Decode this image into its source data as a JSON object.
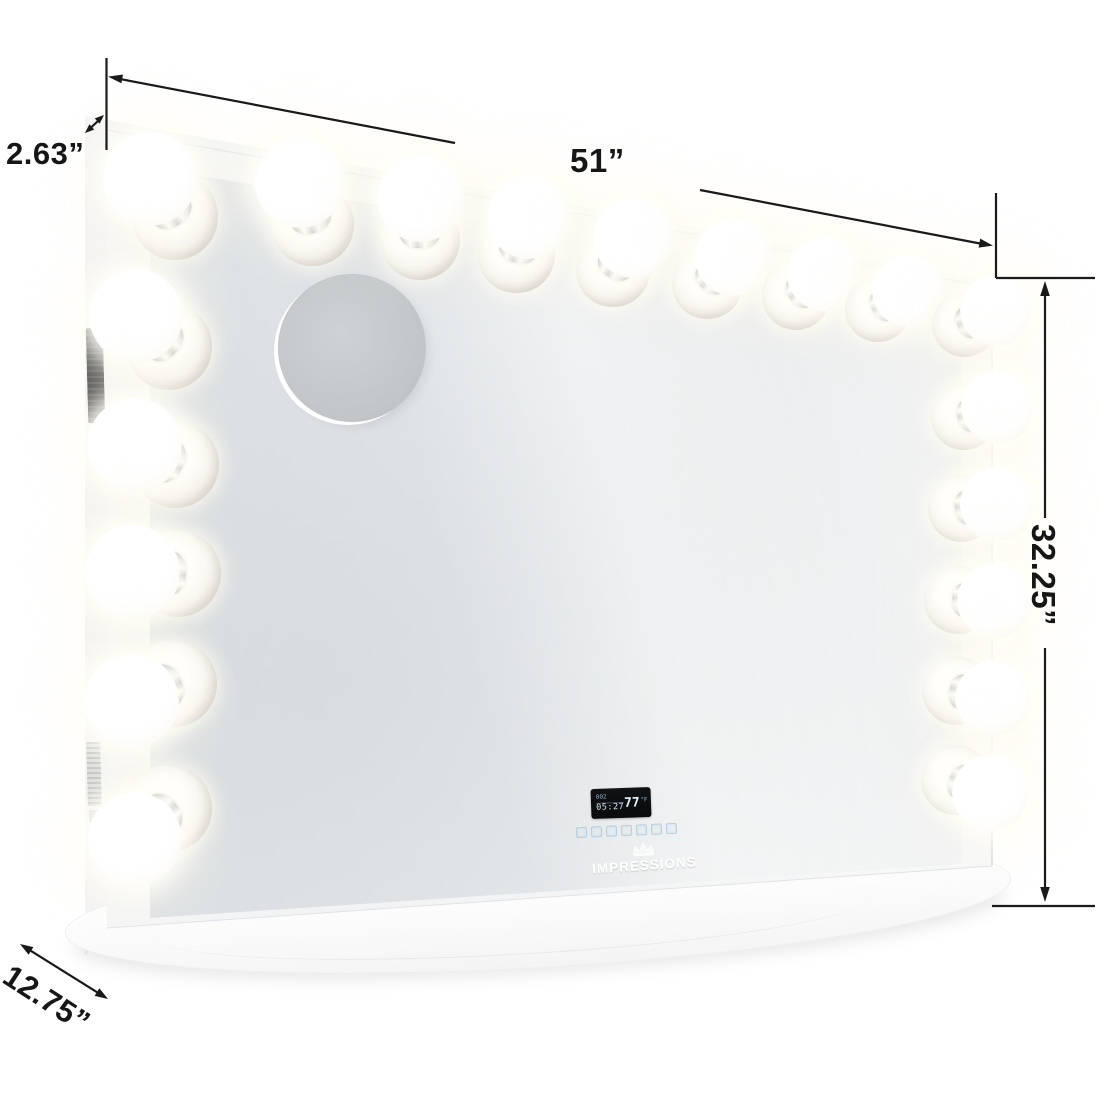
{
  "figure": {
    "type": "product-dimension-diagram",
    "subject": "lighted vanity mirror with base tray",
    "bulb_count": 19,
    "bulbs": [
      [
        150,
        179,
        94
      ],
      [
        300,
        183,
        90
      ],
      [
        420,
        198,
        87
      ],
      [
        528,
        217,
        83
      ],
      [
        633,
        238,
        80
      ],
      [
        733,
        257,
        77
      ],
      [
        824,
        274,
        74
      ],
      [
        908,
        291,
        72
      ],
      [
        995,
        310,
        71
      ],
      [
        997,
        407,
        72
      ],
      [
        996,
        504,
        73
      ],
      [
        994,
        601,
        74
      ],
      [
        992,
        698,
        75
      ],
      [
        990,
        793,
        76
      ],
      [
        136,
        316,
        94
      ],
      [
        134,
        445,
        95
      ],
      [
        132,
        572,
        95
      ],
      [
        131,
        701,
        95
      ],
      [
        135,
        839,
        94
      ]
    ],
    "colors": {
      "annotation_line": "#1a1a1a",
      "glass_light": "#f5f6f6",
      "glass_dark": "#e0e4e7",
      "frame_white": "#f8f9f9",
      "lcd_background": "#0b0d0f",
      "lcd_text": "#cfe3f0",
      "touch_key_outline": "#a9c9dd",
      "chrome_dark": "#4e4e50",
      "chrome_light": "#ffffff"
    }
  },
  "annotations": {
    "top_depth": {
      "label": "2.63”"
    },
    "width": {
      "label": "51”"
    },
    "height": {
      "label": "32.25”"
    },
    "base_depth": {
      "label": "12.75”"
    }
  },
  "lcd": {
    "date": "002",
    "time": "05:27",
    "temperature": "77",
    "temperature_unit": "°F"
  },
  "controls": {
    "key_count": 7
  },
  "brand": {
    "name": "IMPRESSIONS",
    "icon": "crown-icon"
  }
}
